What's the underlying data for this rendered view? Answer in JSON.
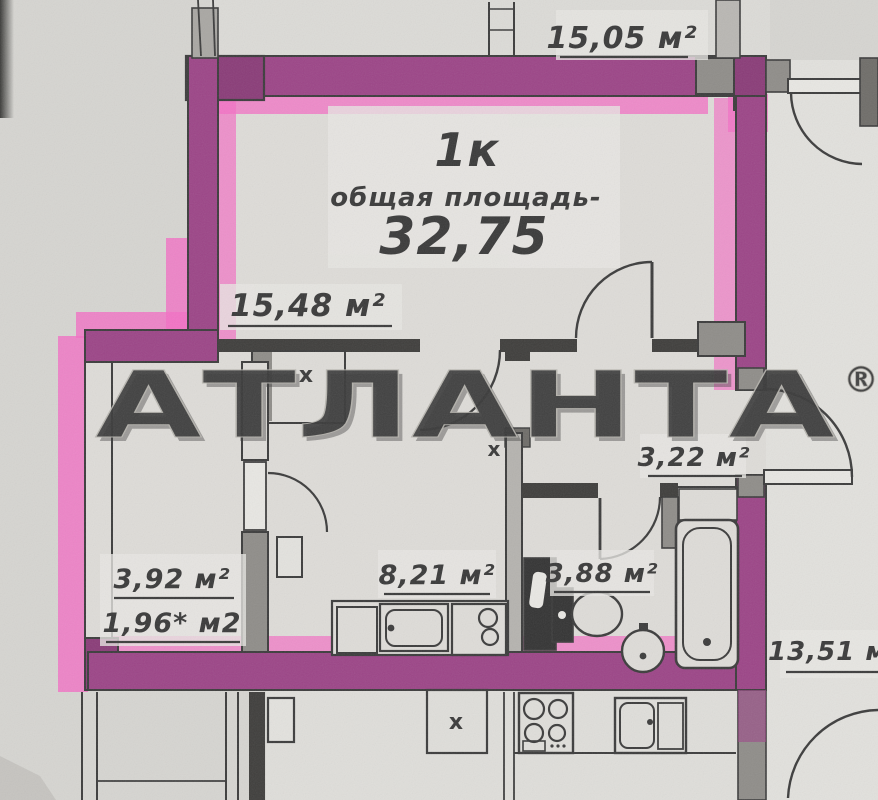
{
  "watermark": {
    "brand": "АТЛАНТА",
    "registered": "®"
  },
  "unit_card": {
    "type": "1к",
    "area_caption": "общая площадь-",
    "total_area": "32,75"
  },
  "labels": {
    "room_above": "15,05 м²",
    "living_room": "15,48 м²",
    "entry_corridor": "3,22 м²",
    "left_room": "3,92 м²",
    "left_room_half": "1,96* м2",
    "hall_kitchen": "8,21 м²",
    "bathroom": "3,88 м²",
    "room_right": "13,51 м²"
  },
  "markers": {
    "vent_shaft": "x"
  },
  "colors": {
    "paper": "#d6d5d1",
    "ink": "#3c3c3c",
    "wall_gray": "#8f8d89",
    "highlighter_pink": "#f36fc4",
    "highlighter_magenta": "#9c4587",
    "watermark_face": "#e8e7e3"
  }
}
